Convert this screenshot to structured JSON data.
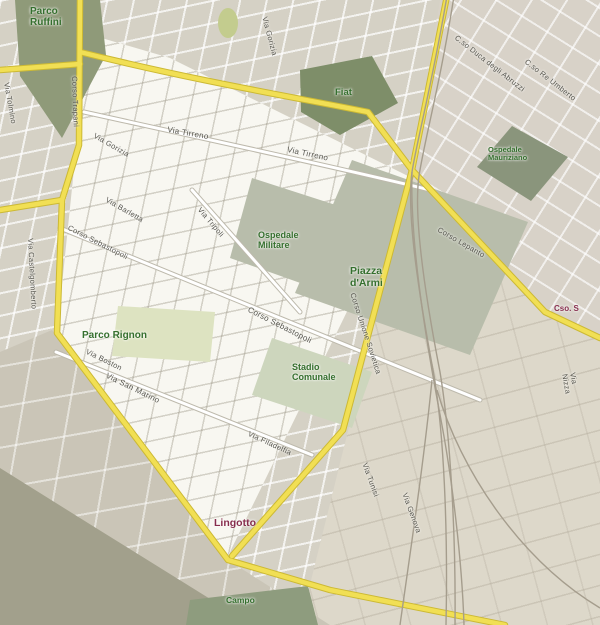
{
  "map": {
    "kind": "street-map",
    "city": "Torino",
    "colors": {
      "outside-bg": "#d5d1c5",
      "inside-bg": "#f8f7f1",
      "topright-bg": "#d8d2c8",
      "bottomright-bg": "#ddd8c9",
      "mirafiori-bg": "#cac5b6",
      "river-dark": "#a2a08b",
      "road-yellow": "#f2df4e",
      "road-yellow-casing": "#cdb92f",
      "road-white": "#ffffff",
      "road-white-casing": "#bdb9ab",
      "railway": "#a59d8c",
      "park-dark": "#8f9a78",
      "fiat-green": "#7e8e68",
      "hospital-green": "#8a957b",
      "piazza-grey": "#b8bdaa",
      "park-light": "#cdd6bc",
      "rignon-green": "#dde3c0",
      "small-park": "#c3cc8c",
      "campo-green": "#8e9c7d",
      "label-green": "#33702c",
      "label-maroon": "#8a2c4d",
      "street-text": "#55544c"
    },
    "labels": [
      {
        "id": "parco-ruffini",
        "kind": "park",
        "text": "Parco\nRuffini",
        "x": 30,
        "y": 6,
        "rot": 0,
        "size": 10
      },
      {
        "id": "fiat",
        "kind": "poi",
        "text": "Fiat",
        "x": 335,
        "y": 88,
        "rot": 0,
        "size": 9.5
      },
      {
        "id": "ospedale-militare",
        "kind": "poi",
        "text": "Ospedale\nMilitare",
        "x": 258,
        "y": 230,
        "rot": 0,
        "size": 9
      },
      {
        "id": "piazza-darmi",
        "kind": "park",
        "text": "Piazza\nd'Armi",
        "x": 350,
        "y": 266,
        "rot": 0,
        "size": 10.5
      },
      {
        "id": "stadio-comunale",
        "kind": "poi",
        "text": "Stadio\nComunale",
        "x": 292,
        "y": 362,
        "rot": 0,
        "size": 9
      },
      {
        "id": "parco-rignon",
        "kind": "park",
        "text": "Parco Rignon",
        "x": 82,
        "y": 330,
        "rot": 0,
        "size": 10
      },
      {
        "id": "ospedale-mauriziano",
        "kind": "poi",
        "text": "Ospedale\nMauriziano",
        "x": 488,
        "y": 146,
        "rot": 0,
        "size": 7.5
      },
      {
        "id": "campo",
        "kind": "poi",
        "text": "Campo",
        "x": 226,
        "y": 596,
        "rot": 0,
        "size": 8.5
      },
      {
        "id": "lingotto",
        "kind": "locality",
        "text": "Lingotto",
        "x": 214,
        "y": 518,
        "rot": 0,
        "size": 10.5
      },
      {
        "id": "cso-s",
        "kind": "locality",
        "text": "Cso. S",
        "x": 554,
        "y": 305,
        "rot": 0,
        "size": 8
      },
      {
        "id": "via-tirreno-1",
        "kind": "street",
        "text": "Via Tirreno",
        "x": 168,
        "y": 126,
        "rot": 10,
        "size": 8
      },
      {
        "id": "via-tirreno-2",
        "kind": "street",
        "text": "Via Tirreno",
        "x": 288,
        "y": 146,
        "rot": 12,
        "size": 8
      },
      {
        "id": "via-gorizia",
        "kind": "street",
        "text": "Via Gorizia",
        "x": 96,
        "y": 132,
        "rot": 30,
        "size": 7.5
      },
      {
        "id": "via-barletta",
        "kind": "street",
        "text": "Via Barletta",
        "x": 108,
        "y": 196,
        "rot": 30,
        "size": 7.5
      },
      {
        "id": "corso-sebastopoli-1",
        "kind": "street",
        "text": "Corso Sebastopoli",
        "x": 70,
        "y": 224,
        "rot": 27,
        "size": 7.5
      },
      {
        "id": "corso-sebastopoli-2",
        "kind": "street",
        "text": "Corso Sebastopoli",
        "x": 250,
        "y": 306,
        "rot": 27,
        "size": 8
      },
      {
        "id": "via-tripoli",
        "kind": "street",
        "text": "Via Tripoli",
        "x": 202,
        "y": 206,
        "rot": 50,
        "size": 7.5
      },
      {
        "id": "via-boston",
        "kind": "street",
        "text": "Via Boston",
        "x": 88,
        "y": 348,
        "rot": 26,
        "size": 7.5
      },
      {
        "id": "via-san-marino",
        "kind": "street",
        "text": "Via San Marino",
        "x": 108,
        "y": 372,
        "rot": 26,
        "size": 8
      },
      {
        "id": "via-castelgomberto",
        "kind": "street",
        "text": "Via Castelgomberto",
        "x": 34,
        "y": 238,
        "rot": 87,
        "size": 7.5
      },
      {
        "id": "corso-trapani",
        "kind": "street",
        "text": "Corso Trapani",
        "x": 78,
        "y": 76,
        "rot": 88,
        "size": 7.5
      },
      {
        "id": "via-tolmino",
        "kind": "street",
        "text": "Via Tolmino",
        "x": 10,
        "y": 82,
        "rot": 80,
        "size": 7.5
      },
      {
        "id": "via-gorizia-2",
        "kind": "street",
        "text": "Via Gorizia",
        "x": 268,
        "y": 16,
        "rot": 75,
        "size": 7.5
      },
      {
        "id": "corso-duca-degli-abruzzi",
        "kind": "street",
        "text": "C.so Duca degli Abruzzi",
        "x": 458,
        "y": 34,
        "rot": 38,
        "size": 7.5
      },
      {
        "id": "corso-re-umberto",
        "kind": "street",
        "text": "C.so Re Umberto",
        "x": 528,
        "y": 58,
        "rot": 38,
        "size": 7.5
      },
      {
        "id": "corso-lepanto",
        "kind": "street",
        "text": "Corso Lepanto",
        "x": 440,
        "y": 226,
        "rot": 30,
        "size": 7.5
      },
      {
        "id": "corso-unione-sovietica",
        "kind": "street",
        "text": "Corso Unione Sovietica",
        "x": 356,
        "y": 292,
        "rot": 72,
        "size": 7.5
      },
      {
        "id": "via-filadelfia",
        "kind": "street",
        "text": "Via Filadelfia",
        "x": 250,
        "y": 430,
        "rot": 25,
        "size": 7.5
      },
      {
        "id": "via-tunisi",
        "kind": "street",
        "text": "Via Tunisi",
        "x": 368,
        "y": 462,
        "rot": 70,
        "size": 7.5
      },
      {
        "id": "via-genova",
        "kind": "street",
        "text": "Via Genova",
        "x": 408,
        "y": 492,
        "rot": 70,
        "size": 7.5
      },
      {
        "id": "via-nizza",
        "kind": "street",
        "text": "Via Nizza",
        "x": 576,
        "y": 372,
        "rot": 80,
        "size": 7.5
      }
    ]
  }
}
